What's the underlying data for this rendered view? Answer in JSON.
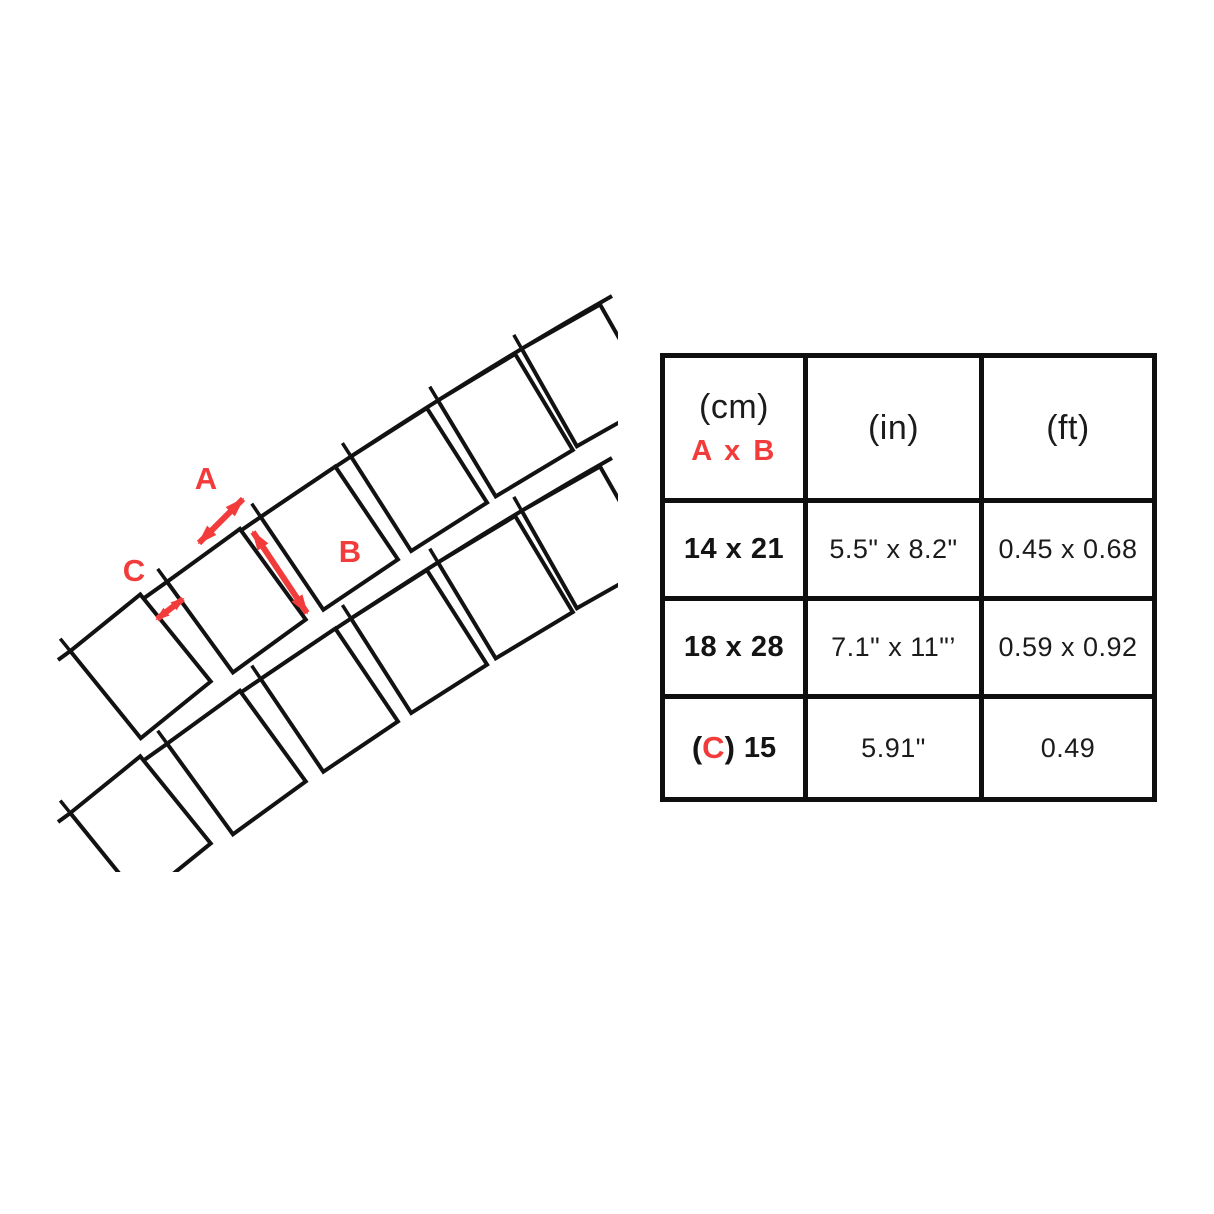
{
  "diagram": {
    "labels": {
      "a": "A",
      "b": "B",
      "c": "C"
    },
    "accent_color": "#f23b3b",
    "line_color": "#121212",
    "description": "curved-lawn-edging-panels-with-dimension-arrows"
  },
  "table": {
    "columns": [
      {
        "unit": "(cm)",
        "sublabel": "A x B"
      },
      {
        "unit": "(in)"
      },
      {
        "unit": "(ft)"
      }
    ],
    "rows": [
      {
        "cm": "14 x 21",
        "inches": "5.5\" x 8.2\"",
        "feet": "0.45 x 0.68"
      },
      {
        "cm": "18 x 28",
        "inches": "7.1\" x 11\"’",
        "feet": "0.59 x 0.92"
      },
      {
        "cm_open": "(",
        "cm_letter": "C",
        "cm_close": ")",
        "cm": "15",
        "inches": "5.91\"",
        "feet": "0.49"
      }
    ]
  }
}
